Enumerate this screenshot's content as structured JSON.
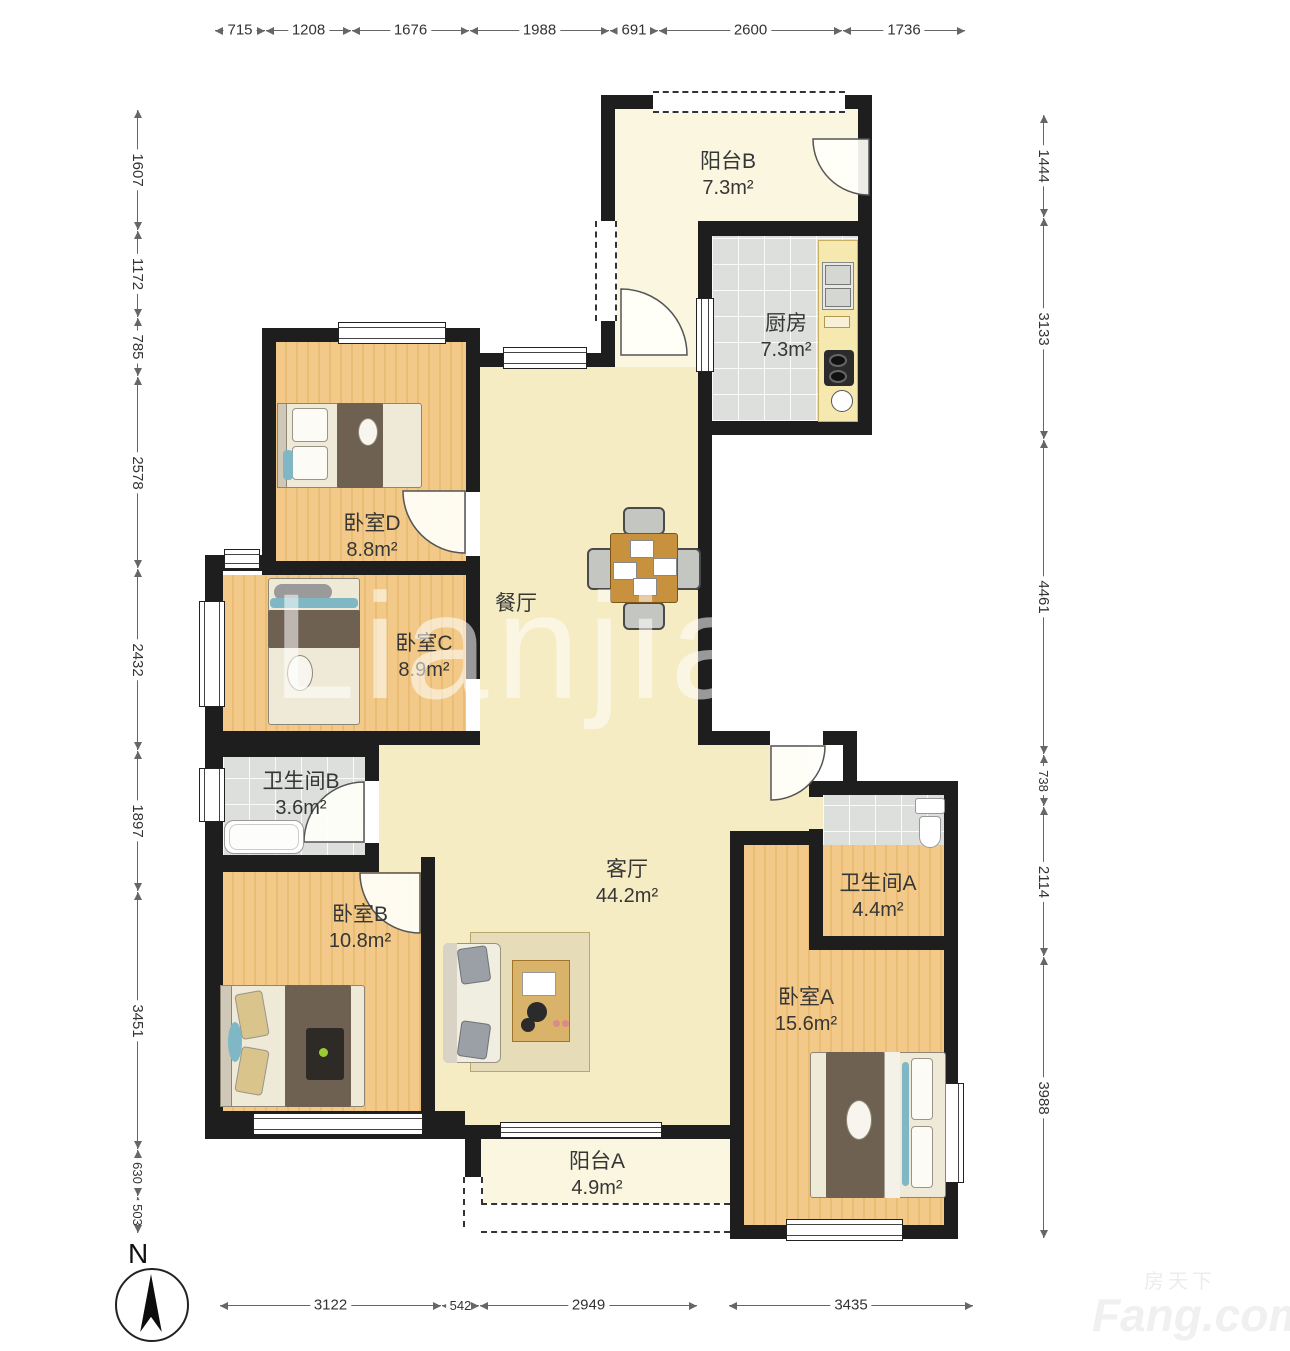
{
  "dims": {
    "top": [
      "715",
      "1208",
      "1676",
      "1988",
      "691",
      "2600",
      "1736"
    ],
    "left": [
      "1607",
      "1172",
      "785",
      "2578",
      "2432",
      "1897",
      "3451",
      "630",
      "503"
    ],
    "right": [
      "1444",
      "3133",
      "4461",
      "738",
      "2114",
      "3988"
    ],
    "bottom": [
      "3122",
      "542",
      "2949",
      "3435"
    ]
  },
  "rooms": {
    "balcony_b": {
      "name": "阳台B",
      "area": "7.3m²"
    },
    "kitchen": {
      "name": "厨房",
      "area": "7.3m²"
    },
    "bedroom_d": {
      "name": "卧室D",
      "area": "8.8m²"
    },
    "bedroom_c": {
      "name": "卧室C",
      "area": "8.9m²"
    },
    "dining": {
      "name": "餐厅",
      "area": ""
    },
    "bath_b": {
      "name": "卫生间B",
      "area": "3.6m²"
    },
    "bedroom_b": {
      "name": "卧室B",
      "area": "10.8m²"
    },
    "living": {
      "name": "客厅",
      "area": "44.2m²"
    },
    "bath_a": {
      "name": "卫生间A",
      "area": "4.4m²"
    },
    "bedroom_a": {
      "name": "卧室A",
      "area": "15.6m²"
    },
    "balcony_a": {
      "name": "阳台A",
      "area": "4.9m²"
    }
  },
  "compass": {
    "label": "N"
  },
  "watermarks": {
    "center": "Lianjia",
    "brand_cn": "房天下",
    "brand_en": "Fang.com"
  }
}
